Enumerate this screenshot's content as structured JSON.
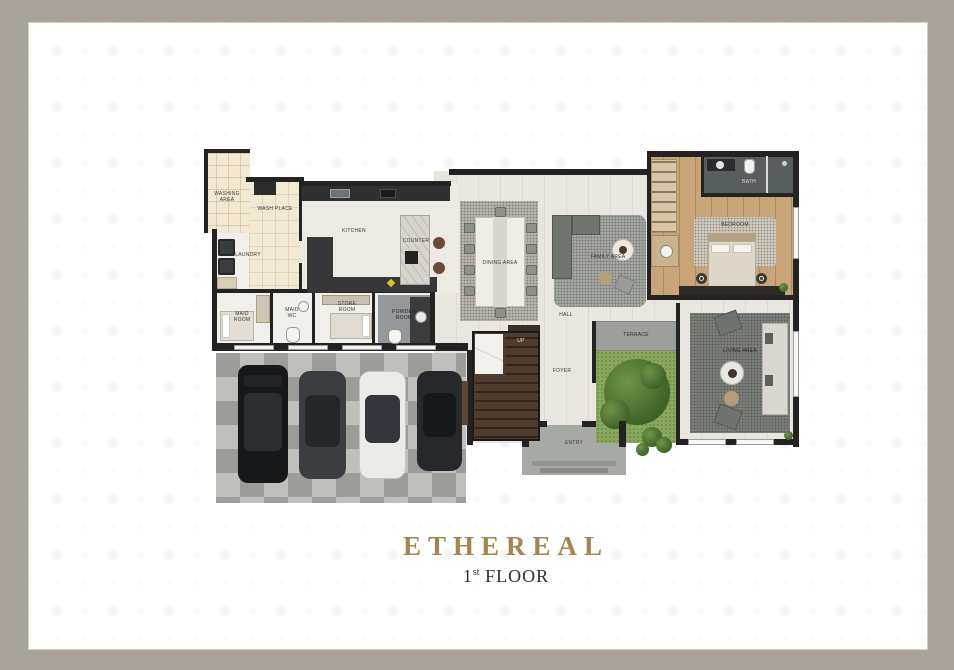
{
  "title": "ETHEREAL",
  "floor": {
    "number": "1",
    "suffix": "st",
    "word": "FLOOR"
  },
  "colors": {
    "frame": "#a9a499",
    "card": "#ffffff",
    "card_outline": "#d9ceba",
    "accent_gold": "#a5854f",
    "subtitle_ink": "#2c2c34",
    "wall": "#232323",
    "garden_green": "#4f7738",
    "bedroom_wood": "#c9a478"
  },
  "plan": {
    "labels": {
      "washing_area": "WASHING AREA",
      "wash_place": "WASH PLACE",
      "laundry": "LAUNDRY",
      "maid_room": "MAID ROOM",
      "maid_wc": "MAID WC",
      "store_room": "STORE ROOM",
      "powder_room": "POWDER ROOM",
      "kitchen": "KITCHEN",
      "counter": "COUNTER",
      "dining_area": "DINING AREA",
      "family_area": "FAMILY AREA",
      "hall": "HALL",
      "up": "UP",
      "foyer": "FOYER",
      "terrace": "TERRACE",
      "living_area": "LIVING AREA",
      "bedroom": "BEDROOM",
      "bath": "BATH",
      "entry": "ENTRY"
    }
  }
}
